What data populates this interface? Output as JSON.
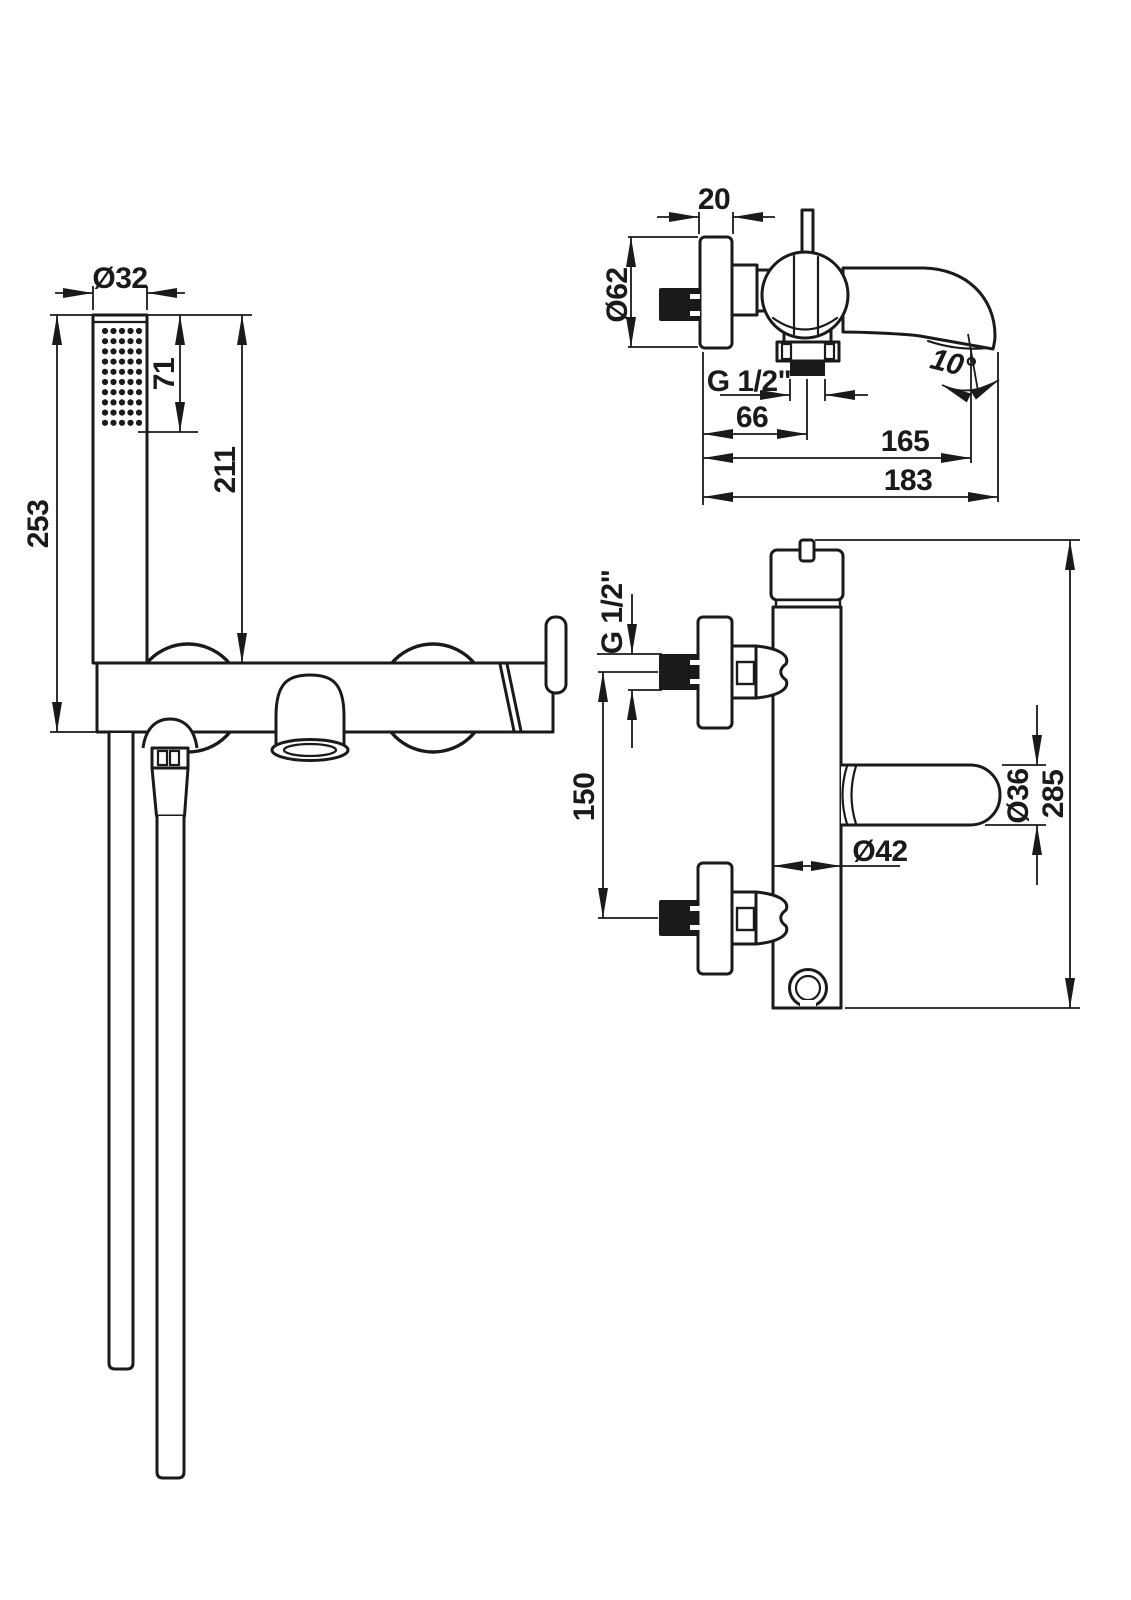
{
  "drawing": {
    "type": "technical-drawing",
    "product": "wall-mounted bath mixer with hand shower set",
    "colors": {
      "line": "#1a1a1a",
      "background": "#ffffff"
    },
    "views": {
      "front": {
        "name": "front view with hand shower",
        "dims": {
          "head_diameter": "Ø32",
          "spray_face_length": "71",
          "handset_length": "211",
          "overall_length": "253"
        }
      },
      "top": {
        "name": "top view",
        "dims": {
          "flange_thickness": "20",
          "flange_diameter": "Ø62",
          "thread": "G 1/2\"",
          "wall_to_thread": "66",
          "wall_to_spout_mouth": "165",
          "total_projection": "183",
          "spout_angle": "10°"
        }
      },
      "side": {
        "name": "side view",
        "dims": {
          "thread": "G 1/2\"",
          "inlet_spacing": "150",
          "lever_diameter": "Ø36",
          "overall_height": "285",
          "body_diameter": "Ø42"
        }
      }
    }
  }
}
